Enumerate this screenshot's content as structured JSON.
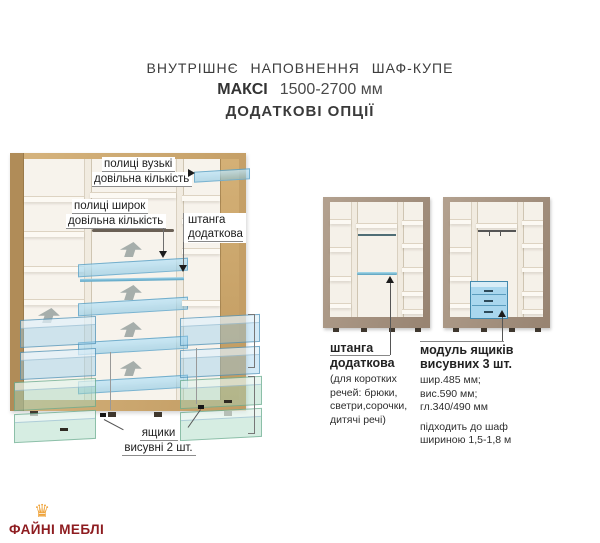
{
  "header": {
    "line1": "ВНУТРІШНЄ НАПОВНЕННЯ ШАФ-КУПЕ",
    "model": "МАКСІ",
    "size_range": "1500-2700 мм",
    "line3": "ДОДАТКОВІ ОПЦІЇ"
  },
  "main_wardrobe": {
    "label_narrow_shelves_line1": "полиці вузькі",
    "label_narrow_shelves_line2": "довільна кількість",
    "label_wide_shelves_line1": "полиці широк",
    "label_wide_shelves_line2": "довільна кількість",
    "label_extra_rod_line1": "штанга",
    "label_extra_rod_line2": "додаткова",
    "label_drawers_line1": "ящики",
    "label_drawers_line2": "висувні 2 шт."
  },
  "option_rod": {
    "title_line1": "штанга",
    "title_line2": "додаткова",
    "desc_line1": "(для коротких",
    "desc_line2": "речей: брюки,",
    "desc_line3": "светри,сорочки,",
    "desc_line4": "дитячі речі)"
  },
  "option_drawer_module": {
    "title_line1": "модуль ящиків",
    "title_line2": "висувних 3 шт.",
    "spec_line1": "шир.485 мм;",
    "spec_line2": "вис.590 мм;",
    "spec_line3": "гл.340/490 мм",
    "note_line1": "підходить до шаф",
    "note_line2": "шириною 1,5-1,8 м"
  },
  "logo": {
    "brand": "ФАЙНІ МЕБЛІ",
    "crown_glyph": "♛"
  },
  "colors": {
    "oak": "#c9a36b",
    "taupe": "#a3907e",
    "option_blue": "#9ed3ec",
    "option_green": "#b3dfc6",
    "logo_red": "#8e1c20",
    "crown_gold": "#efa33a"
  }
}
